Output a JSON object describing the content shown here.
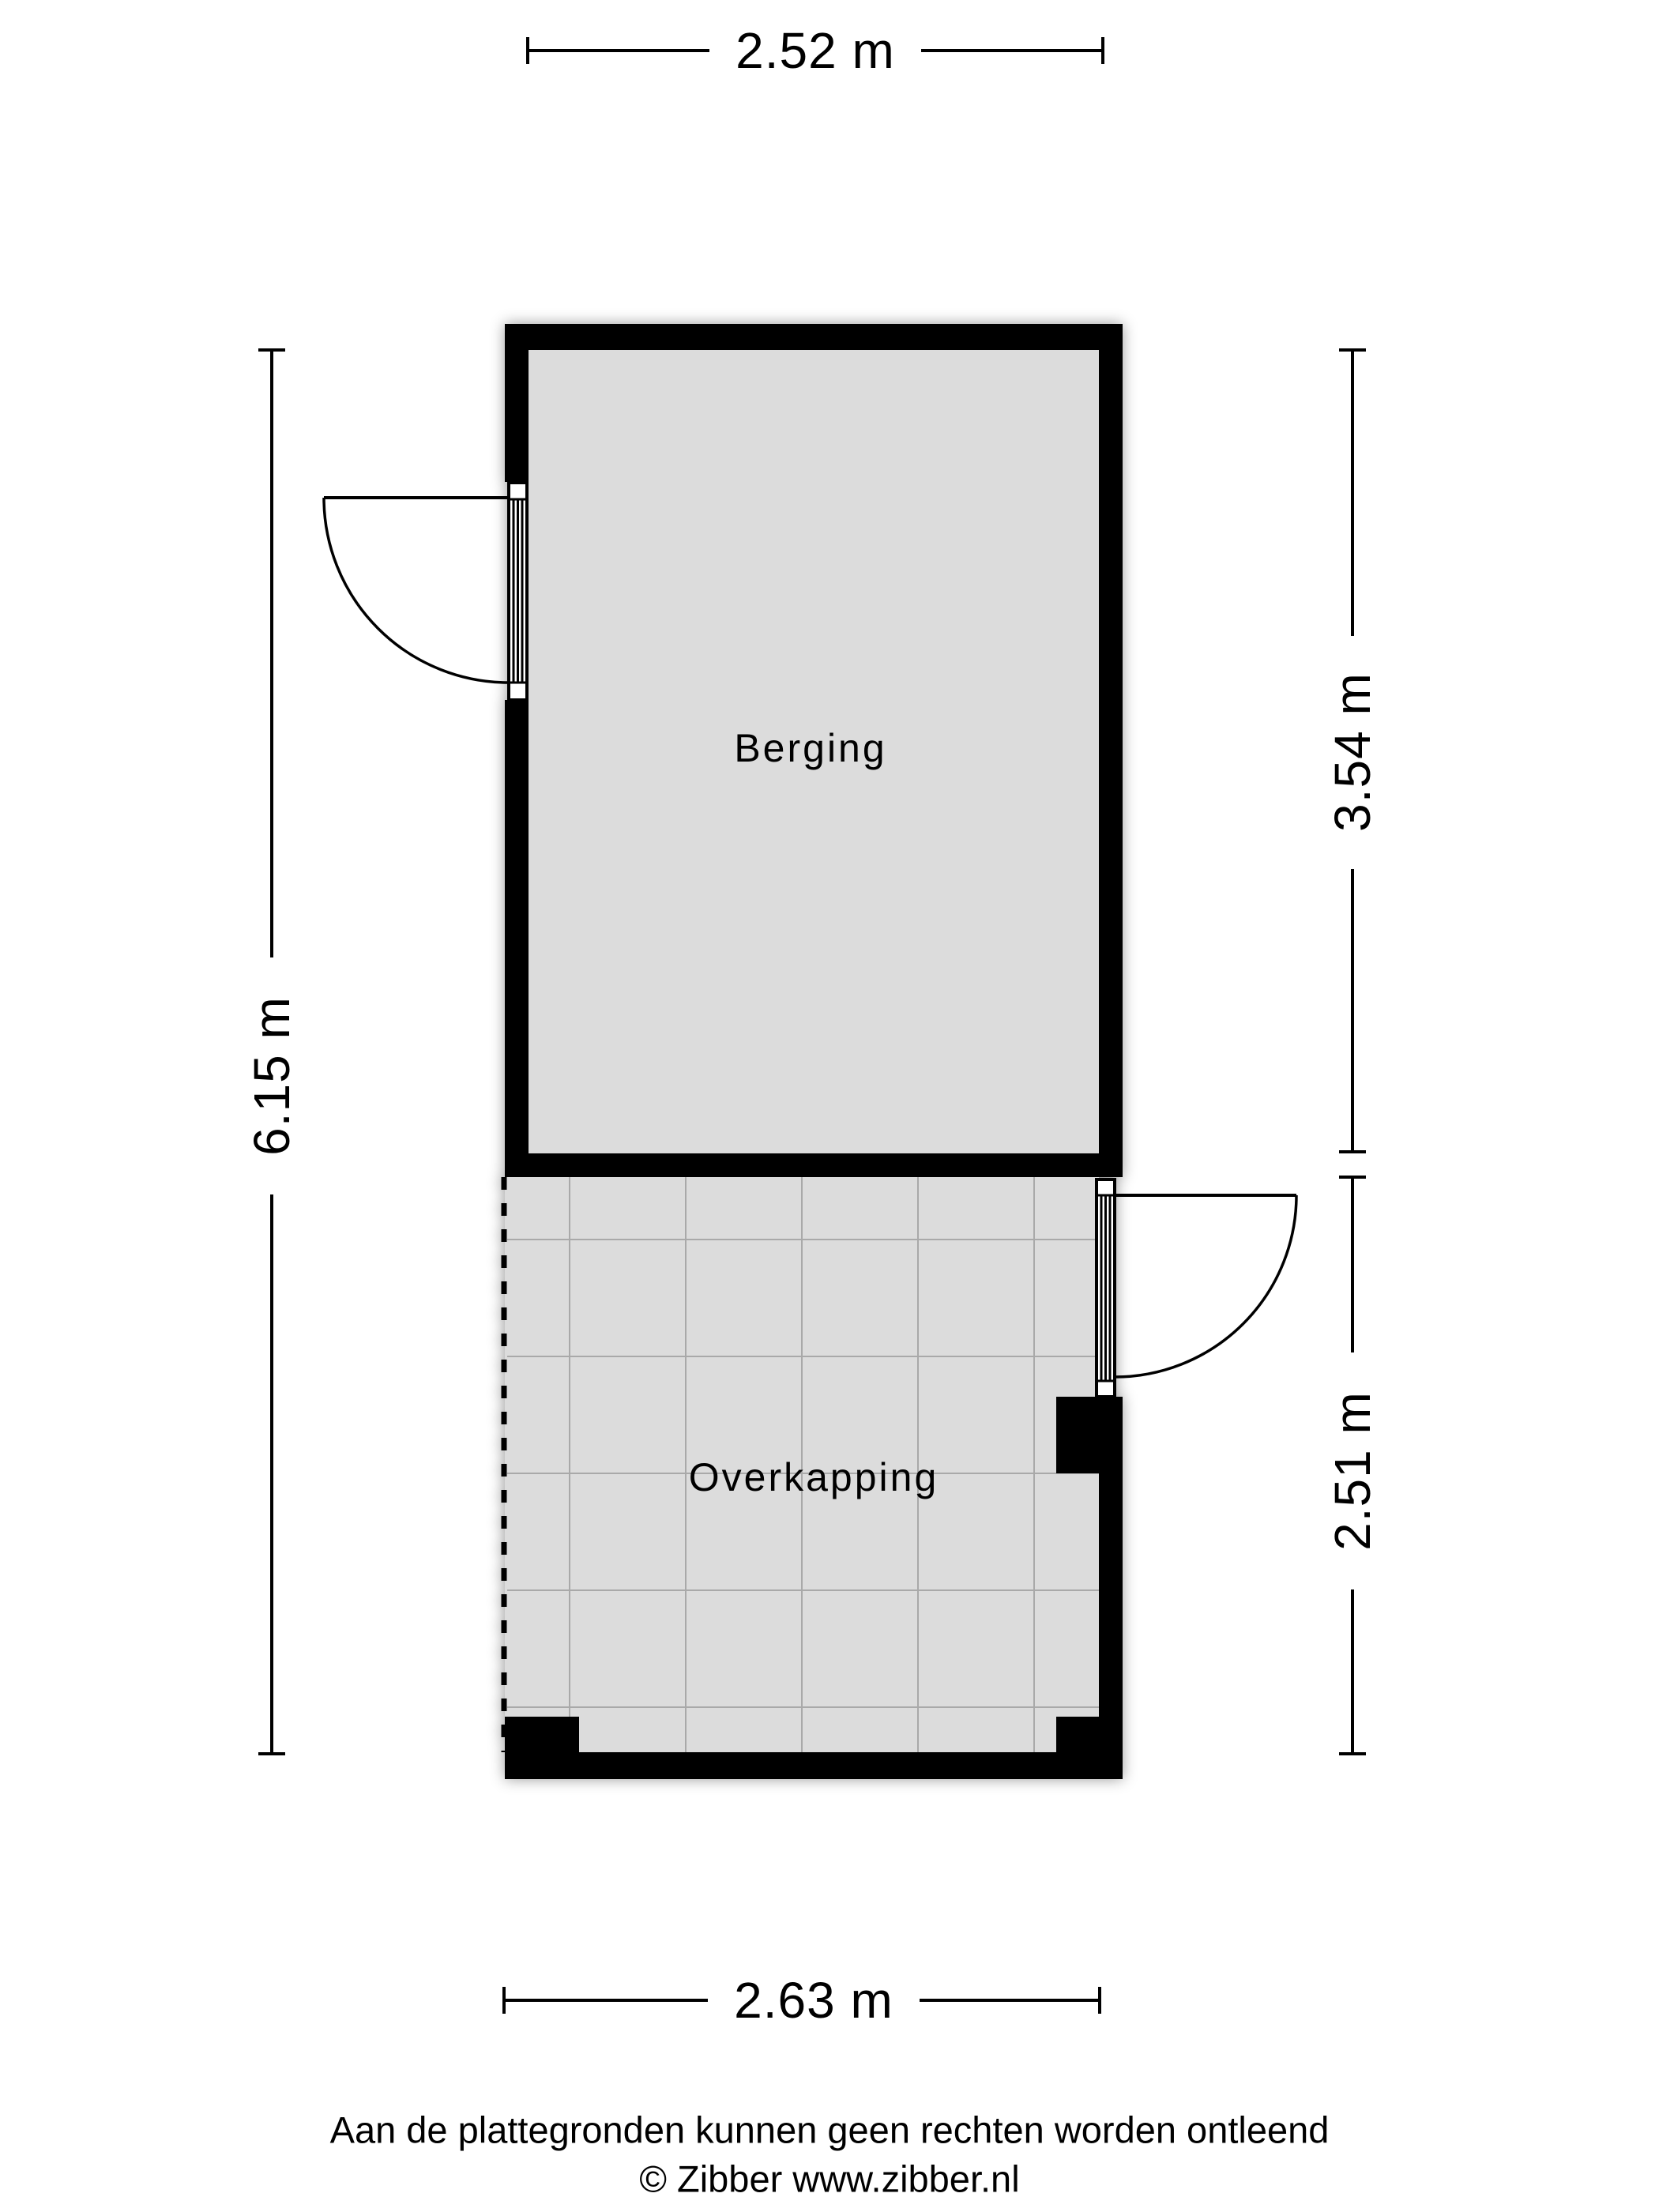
{
  "plan": {
    "rooms": [
      {
        "name": "berging",
        "label": "Berging"
      },
      {
        "name": "overkapping",
        "label": "Overkapping"
      }
    ]
  },
  "dimensions": {
    "top": {
      "label": "2.52 m"
    },
    "left": {
      "label": "6.15 m"
    },
    "right_upper": {
      "label": "3.54 m"
    },
    "right_lower": {
      "label": "2.51 m"
    },
    "bottom": {
      "label": "2.63 m"
    }
  },
  "footer": {
    "disclaimer": "Aan de plattegronden kunnen geen rechten worden ontleend",
    "copyright": "© Zibber www.zibber.nl"
  },
  "colors": {
    "wall": "#000000",
    "floor": "#dcdcdc",
    "grid_line": "#a9a9a9",
    "line": "#000000",
    "background": "#ffffff",
    "text": "#000000"
  }
}
